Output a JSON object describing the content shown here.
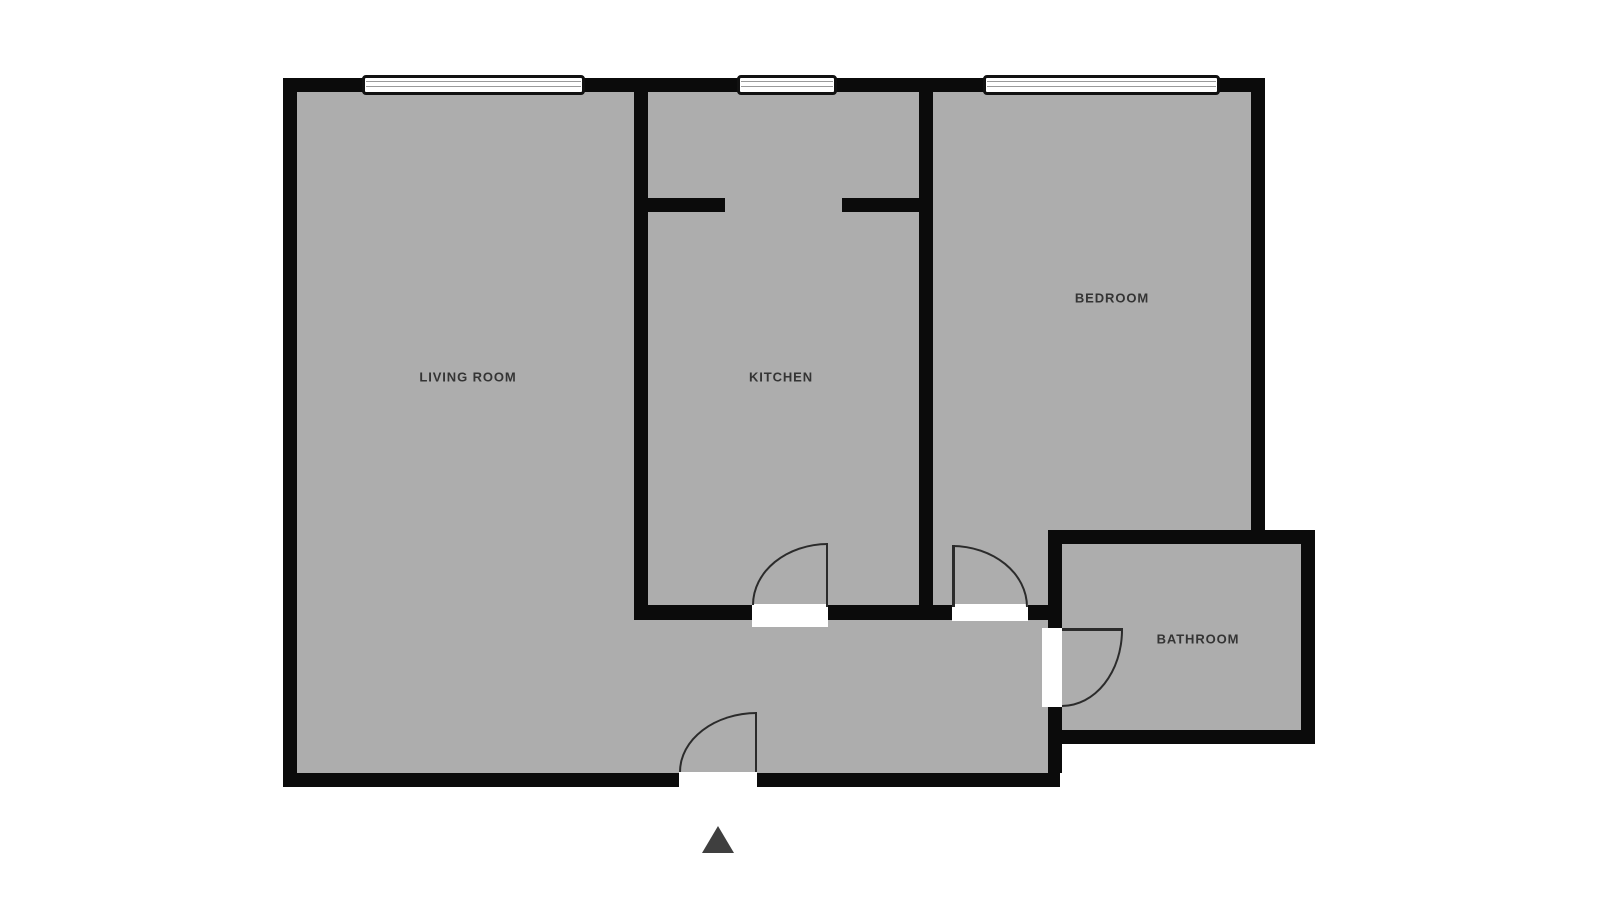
{
  "diagram": {
    "type": "apartment-floor-plan",
    "rooms": {
      "living_room": {
        "label": "LIVING ROOM"
      },
      "kitchen": {
        "label": "KITCHEN"
      },
      "bedroom": {
        "label": "BEDROOM"
      },
      "bathroom": {
        "label": "BATHROOM"
      }
    },
    "features": {
      "windows": [
        "living-room-window",
        "kitchen-window",
        "bedroom-window"
      ],
      "doors": [
        "kitchen-door",
        "bedroom-door",
        "bathroom-door",
        "entrance-door"
      ],
      "entrance_marker": "triangle-pointer"
    },
    "colors": {
      "background": "#ffffff",
      "floor_fill": "#adadad",
      "wall": "#0b0b0b",
      "label_text": "#343434",
      "door_arc": "#2b2b2b",
      "window_pane_line": "#9a9a9a",
      "entrance_marker": "#3f3f3f"
    }
  }
}
